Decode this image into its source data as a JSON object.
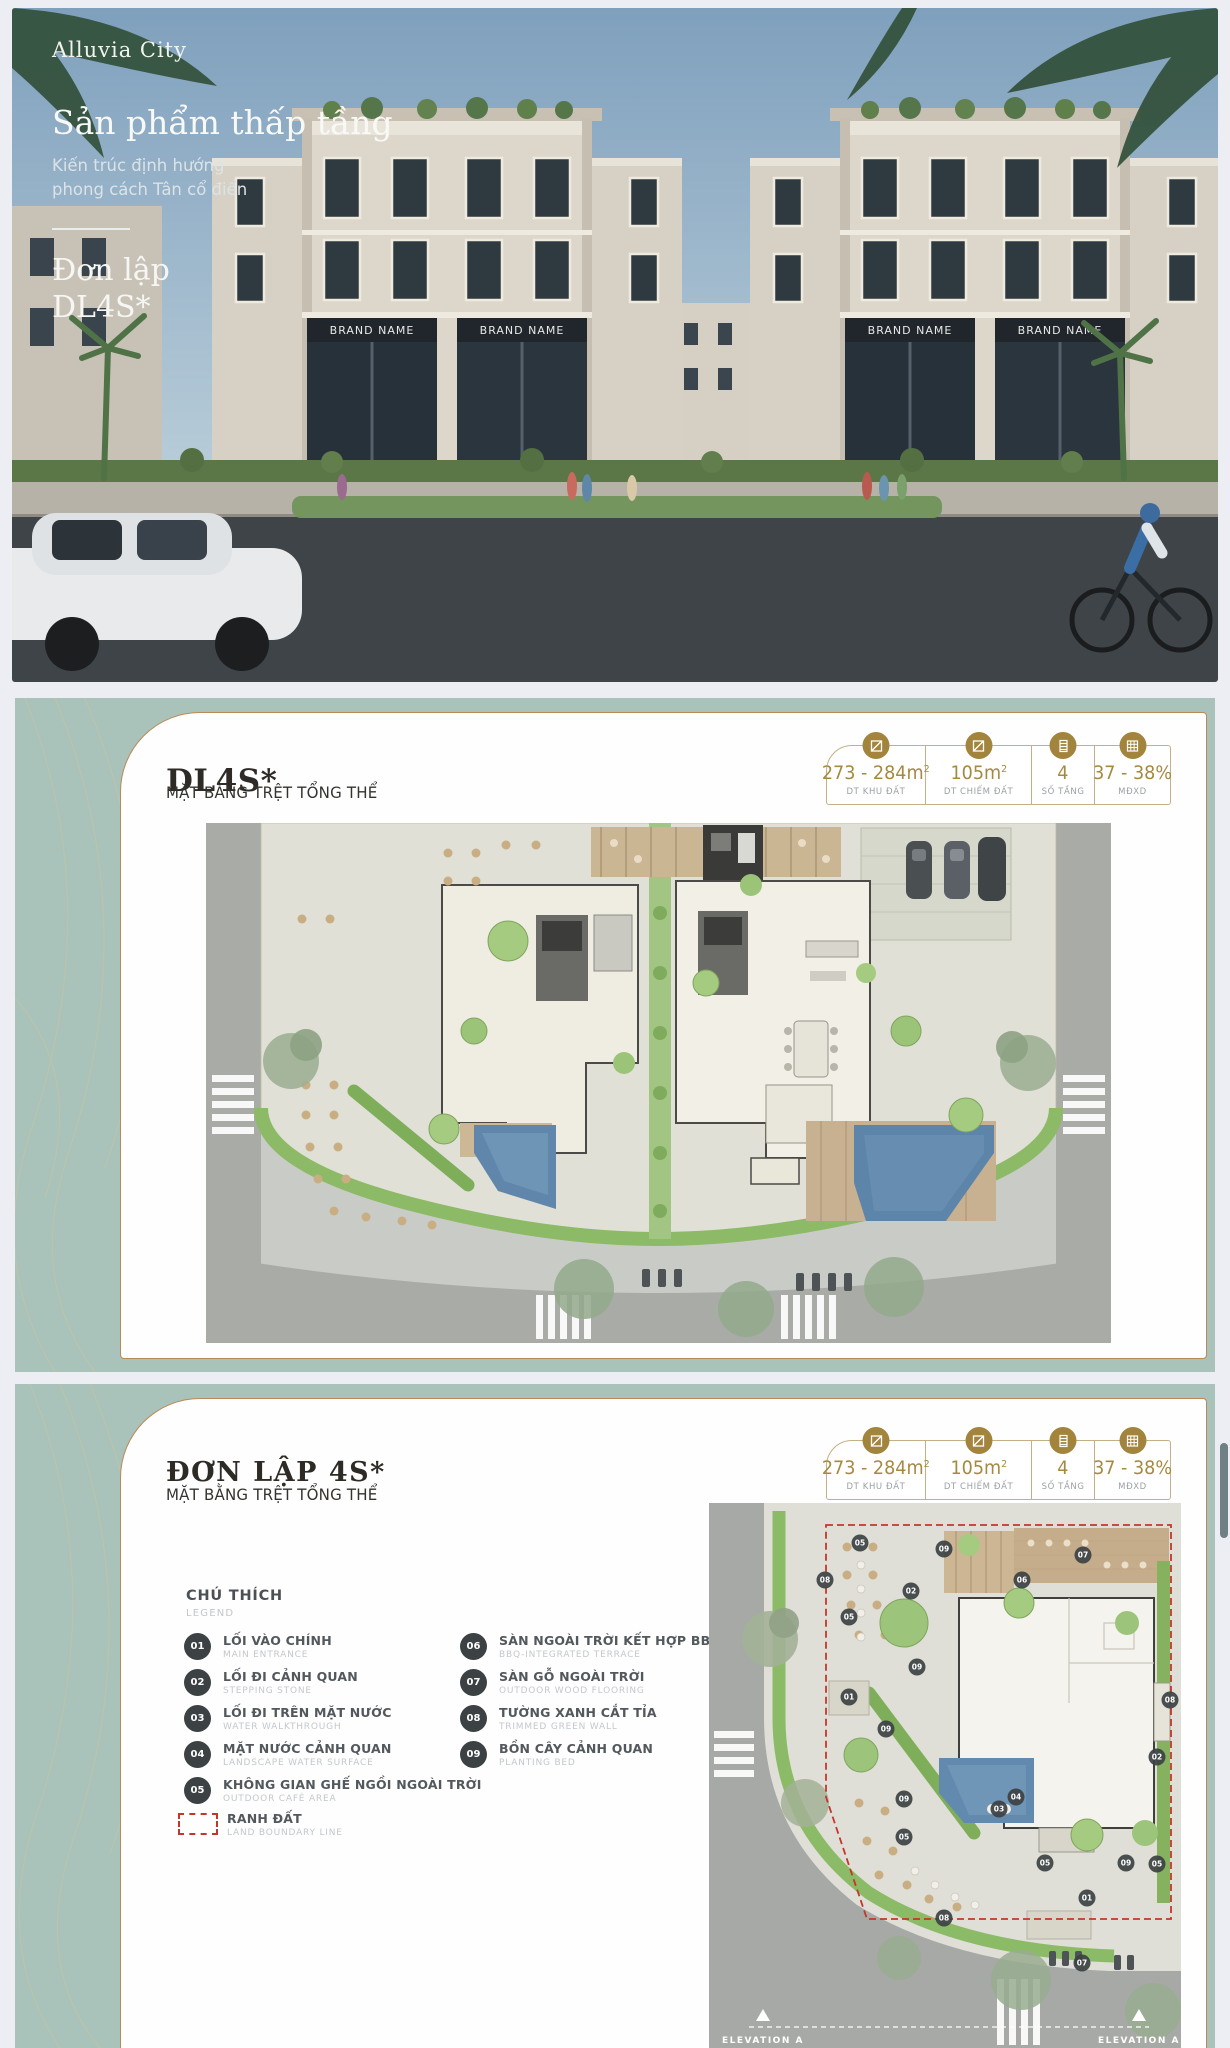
{
  "hero": {
    "logo": "Alluvia City",
    "title": "Sản phẩm thấp tầng",
    "subtitle_line1": "Kiến trúc định hướng",
    "subtitle_line2": "phong cách Tân cổ điển",
    "product_line1": "Đơn lập",
    "product_line2": "DL4S*",
    "brand_sign": "BRAND NAME"
  },
  "stats": {
    "items": [
      {
        "value": "273 - 284m",
        "sup": "2",
        "label": "DT KHU ĐẤT"
      },
      {
        "value": "105m",
        "sup": "2",
        "label": "DT CHIẾM ĐẤT"
      },
      {
        "value": "4",
        "sup": "",
        "label": "SỐ TẦNG"
      },
      {
        "value": "37 - 38%",
        "sup": "",
        "label": "MĐXD"
      }
    ]
  },
  "card1": {
    "title": "DL4S*",
    "subtitle": "MẶT BẰNG TRỆT TỔNG THỂ"
  },
  "card2": {
    "title": "ĐƠN LẬP 4S*",
    "subtitle": "MẶT BẰNG TRỆT TỔNG THỂ",
    "legend": {
      "title": "CHÚ THÍCH",
      "subtitle": "LEGEND",
      "items_left": [
        {
          "num": "01",
          "vi": "LỐI VÀO CHÍNH",
          "en": "MAIN ENTRANCE"
        },
        {
          "num": "02",
          "vi": "LỐI ĐI CẢNH QUAN",
          "en": "STEPPING STONE"
        },
        {
          "num": "03",
          "vi": "LỐI ĐI TRÊN MẶT NƯỚC",
          "en": "WATER WALKTHROUGH"
        },
        {
          "num": "04",
          "vi": "MẶT NƯỚC CẢNH QUAN",
          "en": "LANDSCAPE WATER SURFACE"
        },
        {
          "num": "05",
          "vi": "KHÔNG GIAN GHẾ NGỒI NGOÀI TRỜI",
          "en": "OUTDOOR CAFÉ AREA"
        }
      ],
      "boundary": {
        "vi": "RANH ĐẤT",
        "en": "LAND BOUNDARY LINE"
      },
      "items_right": [
        {
          "num": "06",
          "vi": "SÀN NGOÀI TRỜI KẾT HỢP BBQ",
          "en": "BBQ-INTEGRATED TERRACE"
        },
        {
          "num": "07",
          "vi": "SÀN GỖ NGOÀI TRỜI",
          "en": "OUTDOOR WOOD FLOORING"
        },
        {
          "num": "08",
          "vi": "TƯỜNG XANH CẮT TỈA",
          "en": "TRIMMED GREEN WALL"
        },
        {
          "num": "09",
          "vi": "BỒN CÂY CẢNH QUAN",
          "en": "PLANTING BED"
        }
      ]
    },
    "plan2": {
      "elevation_label": "ELEVATION A",
      "markers": [
        {
          "label": "05",
          "x": 151,
          "y": 40
        },
        {
          "label": "09",
          "x": 235,
          "y": 46
        },
        {
          "label": "07",
          "x": 374,
          "y": 52
        },
        {
          "label": "06",
          "x": 313,
          "y": 77
        },
        {
          "label": "02",
          "x": 202,
          "y": 88
        },
        {
          "label": "08",
          "x": 116,
          "y": 77
        },
        {
          "label": "05",
          "x": 140,
          "y": 114
        },
        {
          "label": "09",
          "x": 208,
          "y": 164
        },
        {
          "label": "01",
          "x": 140,
          "y": 194
        },
        {
          "label": "09",
          "x": 177,
          "y": 226
        },
        {
          "label": "08",
          "x": 461,
          "y": 197
        },
        {
          "label": "02",
          "x": 448,
          "y": 254
        },
        {
          "label": "09",
          "x": 195,
          "y": 296
        },
        {
          "label": "04",
          "x": 307,
          "y": 294
        },
        {
          "label": "03",
          "x": 290,
          "y": 306
        },
        {
          "label": "05",
          "x": 195,
          "y": 334
        },
        {
          "label": "05",
          "x": 336,
          "y": 360
        },
        {
          "label": "09",
          "x": 417,
          "y": 360
        },
        {
          "label": "05",
          "x": 448,
          "y": 361
        },
        {
          "label": "01",
          "x": 378,
          "y": 395
        },
        {
          "label": "08",
          "x": 235,
          "y": 415
        },
        {
          "label": "07",
          "x": 373,
          "y": 460
        }
      ]
    }
  },
  "colors": {
    "teal_card": "#a9c3bb",
    "gold_border": "#b98a57",
    "gold_accent": "#a2843c",
    "stat_value": "#a5893f",
    "legend_circle": "#3c4143",
    "boundary_red": "#c3372a"
  }
}
